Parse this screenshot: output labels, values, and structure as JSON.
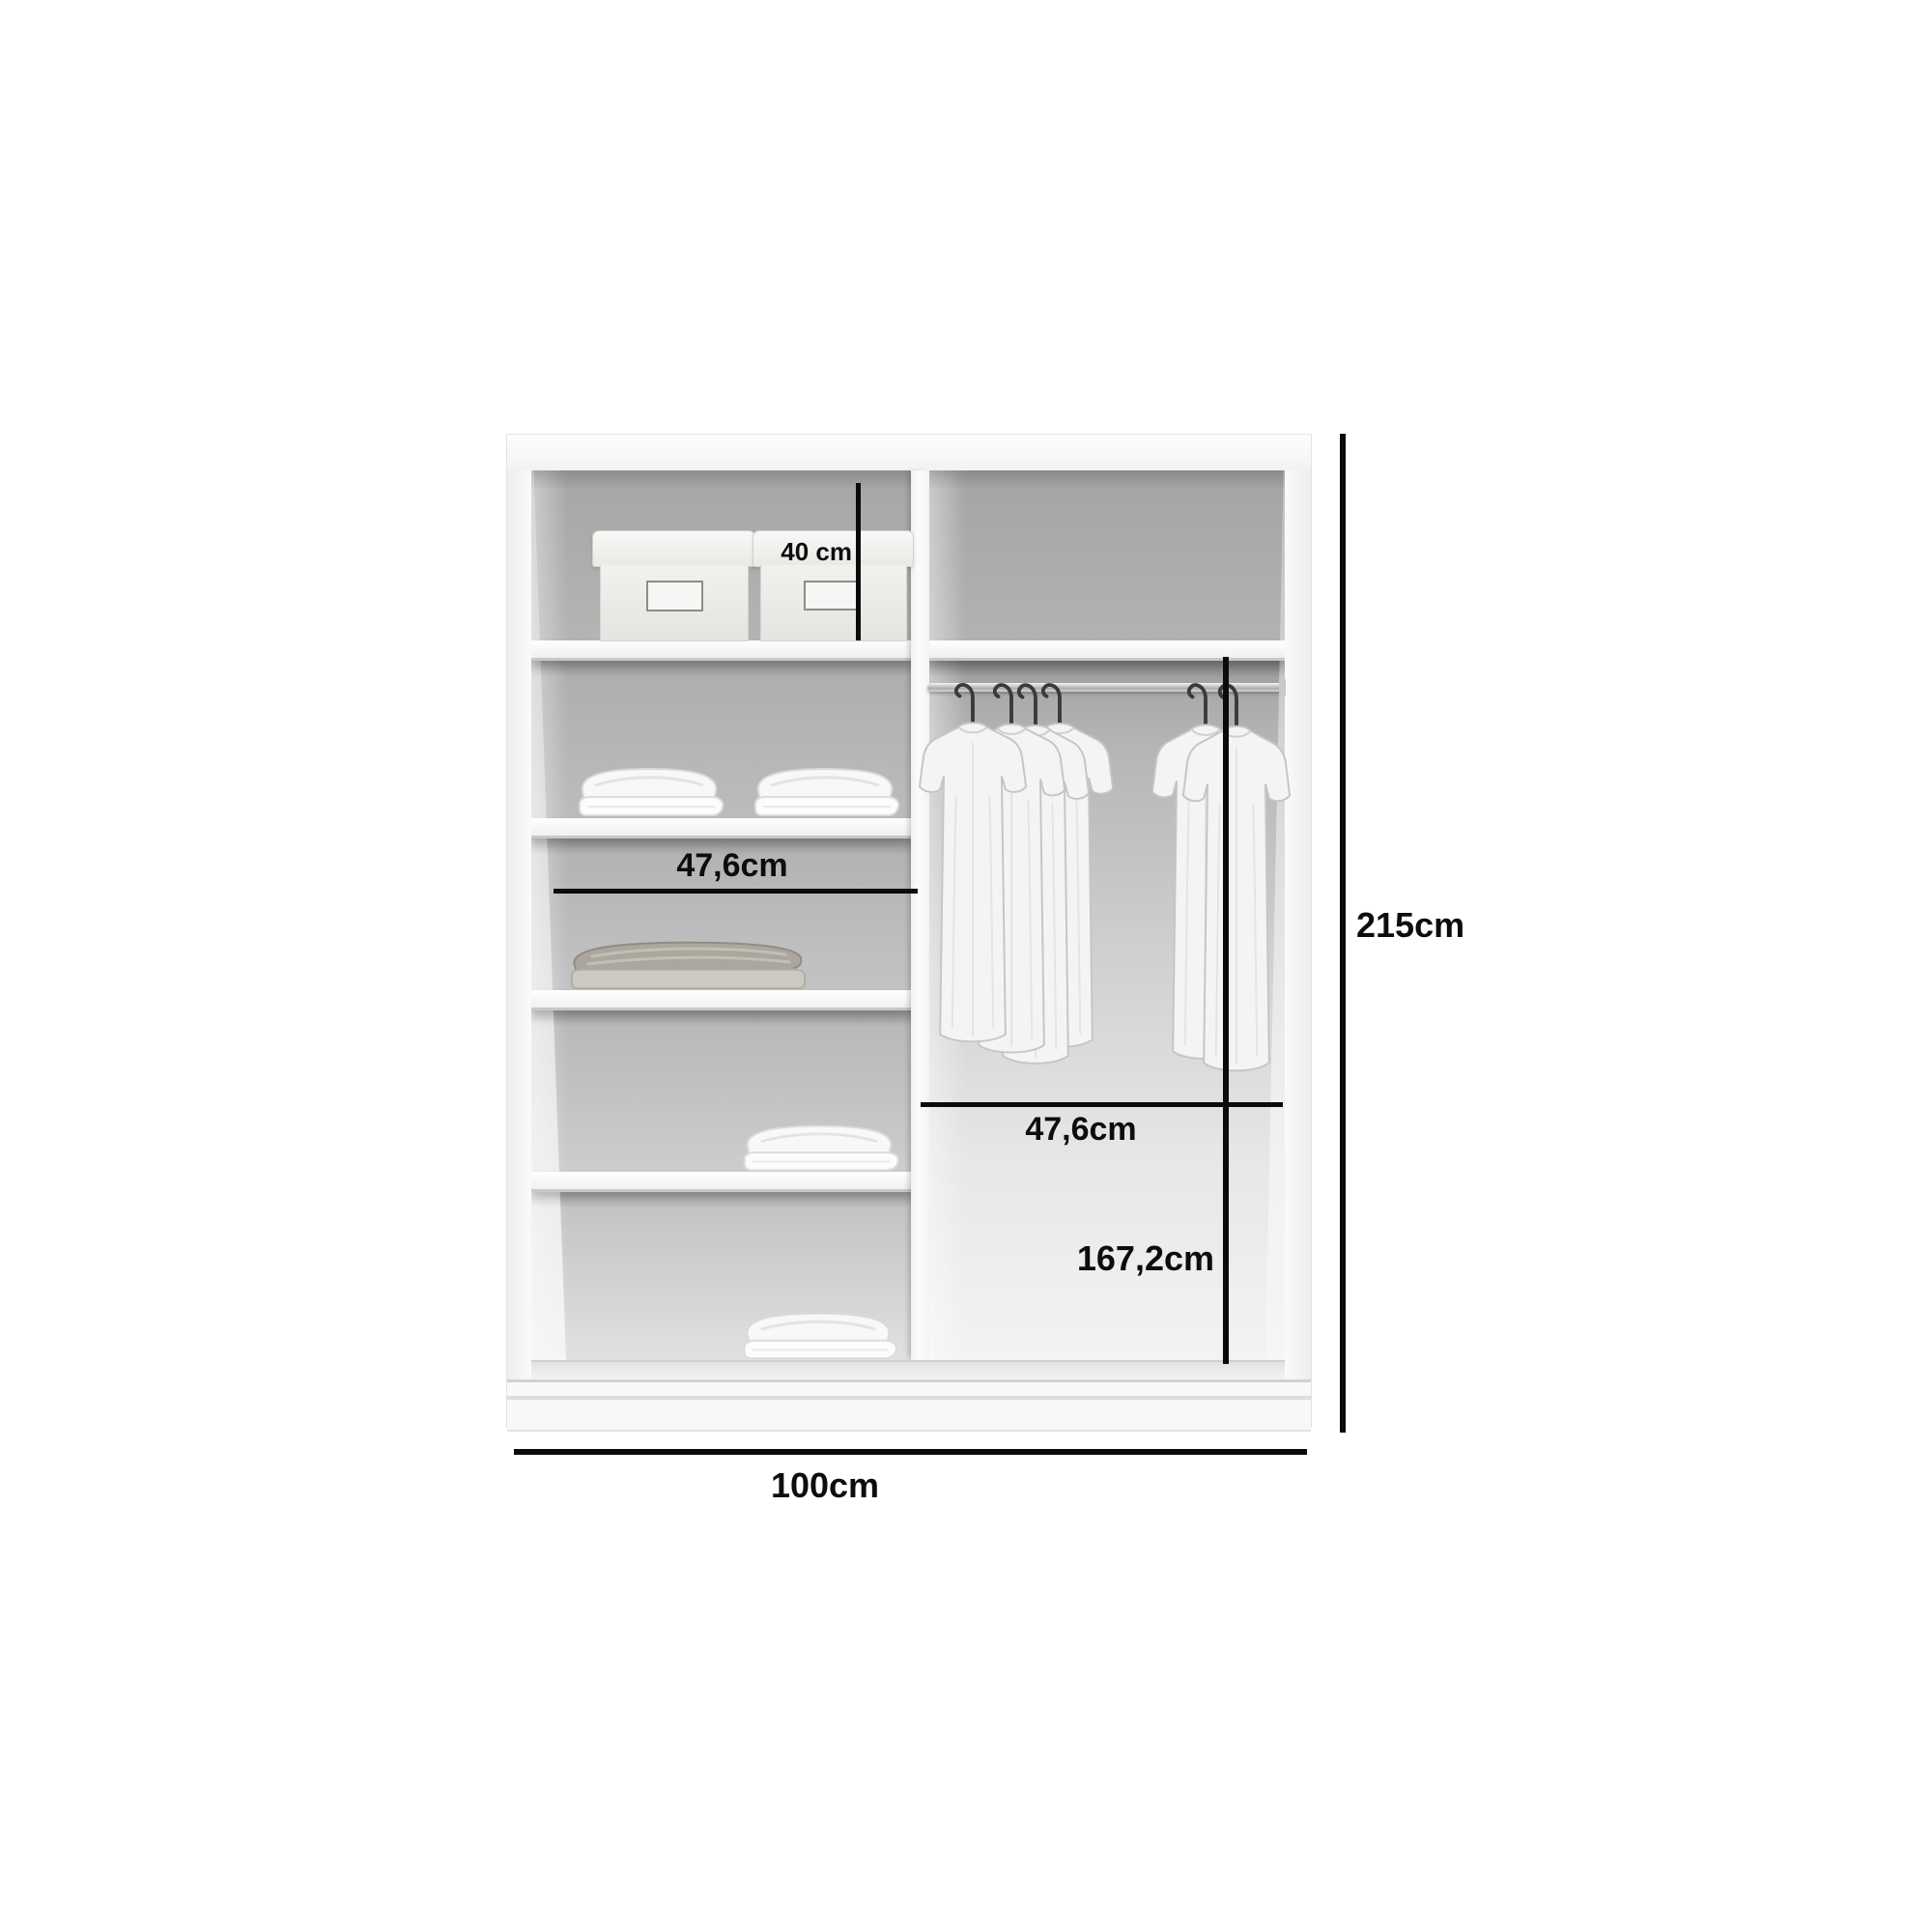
{
  "diagram": {
    "type": "wardrobe-interior-dimension-diagram",
    "labels": {
      "top_shelf_height": "40 cm",
      "left_column_width": "47,6cm",
      "right_column_width": "47,6cm",
      "hanging_section_height": "167,2cm",
      "total_height": "215cm",
      "total_width": "100cm"
    },
    "colors": {
      "dimension_line": "#0b0b0b",
      "label_text": "#0d0d0d",
      "carcass_white": "#f8f8f8",
      "back_panel_gray": "#b0b0b0"
    }
  }
}
